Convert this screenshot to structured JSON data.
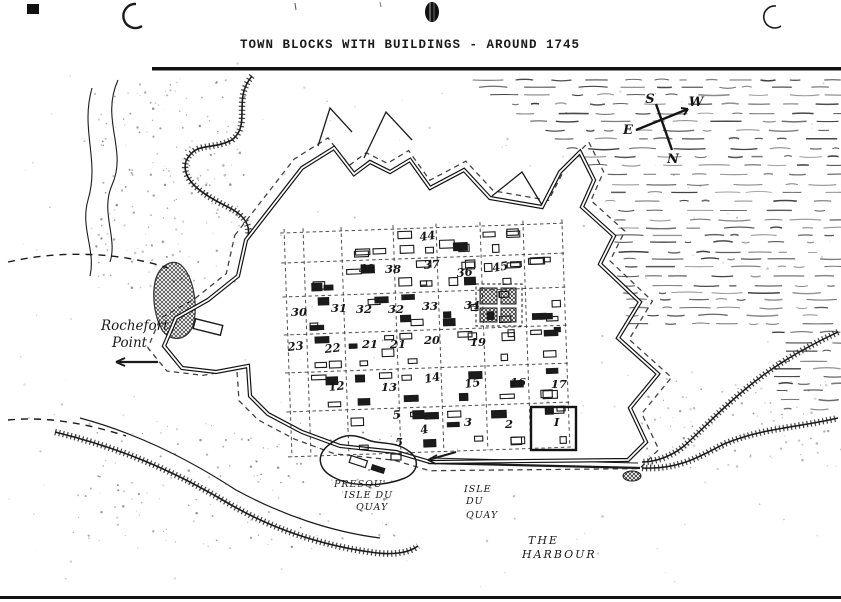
{
  "page": {
    "title": "TOWN BLOCKS WITH BUILDINGS - AROUND 1745"
  },
  "compass": {
    "s": "S",
    "w": "W",
    "e": "E",
    "n": "N"
  },
  "labels": {
    "rochefort_point": {
      "line1": "Rochefort",
      "line2": "Point"
    },
    "presquile_quay": {
      "line1": "PRESQU'",
      "line2": "ISLE DU",
      "line3": "QUAY"
    },
    "isle_du_quay": {
      "line1": "ISLE",
      "line2": "DU",
      "line3": "QUAY"
    },
    "harbour": {
      "line1": "THE",
      "line2": "HARBOUR"
    }
  },
  "blocks": [
    {
      "label": "44",
      "x": 420,
      "y": 241,
      "rot": -8
    },
    {
      "label": "39",
      "x": 359,
      "y": 272,
      "rot": 0
    },
    {
      "label": "38",
      "x": 385,
      "y": 273,
      "rot": 0
    },
    {
      "label": "37",
      "x": 424,
      "y": 269,
      "rot": -4
    },
    {
      "label": "36",
      "x": 457,
      "y": 277,
      "rot": -6
    },
    {
      "label": "45",
      "x": 493,
      "y": 272,
      "rot": -10
    },
    {
      "label": "30",
      "x": 291,
      "y": 316,
      "rot": 0
    },
    {
      "label": "31",
      "x": 331,
      "y": 312,
      "rot": 0
    },
    {
      "label": "32",
      "x": 356,
      "y": 313,
      "rot": 0
    },
    {
      "label": "32",
      "x": 388,
      "y": 313,
      "rot": 0
    },
    {
      "label": "33",
      "x": 422,
      "y": 310,
      "rot": 0
    },
    {
      "label": "34",
      "x": 464,
      "y": 309,
      "rot": 0
    },
    {
      "label": "23",
      "x": 288,
      "y": 351,
      "rot": -6
    },
    {
      "label": "22",
      "x": 325,
      "y": 353,
      "rot": -6
    },
    {
      "label": "21",
      "x": 362,
      "y": 348,
      "rot": 0
    },
    {
      "label": "21",
      "x": 390,
      "y": 348,
      "rot": 0
    },
    {
      "label": "20",
      "x": 424,
      "y": 344,
      "rot": 0
    },
    {
      "label": "19",
      "x": 470,
      "y": 346,
      "rot": 0
    },
    {
      "label": "12",
      "x": 329,
      "y": 391,
      "rot": -6
    },
    {
      "label": "13",
      "x": 381,
      "y": 391,
      "rot": 0
    },
    {
      "label": "14",
      "x": 425,
      "y": 383,
      "rot": -10
    },
    {
      "label": "15",
      "x": 465,
      "y": 388,
      "rot": -8
    },
    {
      "label": "16",
      "x": 510,
      "y": 386,
      "rot": 0
    },
    {
      "label": "17",
      "x": 551,
      "y": 388,
      "rot": 0
    },
    {
      "label": "5",
      "x": 393,
      "y": 419,
      "rot": -5
    },
    {
      "label": "4",
      "x": 421,
      "y": 434,
      "rot": -10
    },
    {
      "label": "3",
      "x": 464,
      "y": 426,
      "rot": 0
    },
    {
      "label": "2",
      "x": 505,
      "y": 428,
      "rot": 0
    },
    {
      "label": "I",
      "x": 554,
      "y": 426,
      "rot": 0
    },
    {
      "label": "5",
      "x": 395,
      "y": 446,
      "rot": 0
    }
  ],
  "colors": {
    "ink": "#1b1b1b",
    "paper": "#ffffff"
  }
}
